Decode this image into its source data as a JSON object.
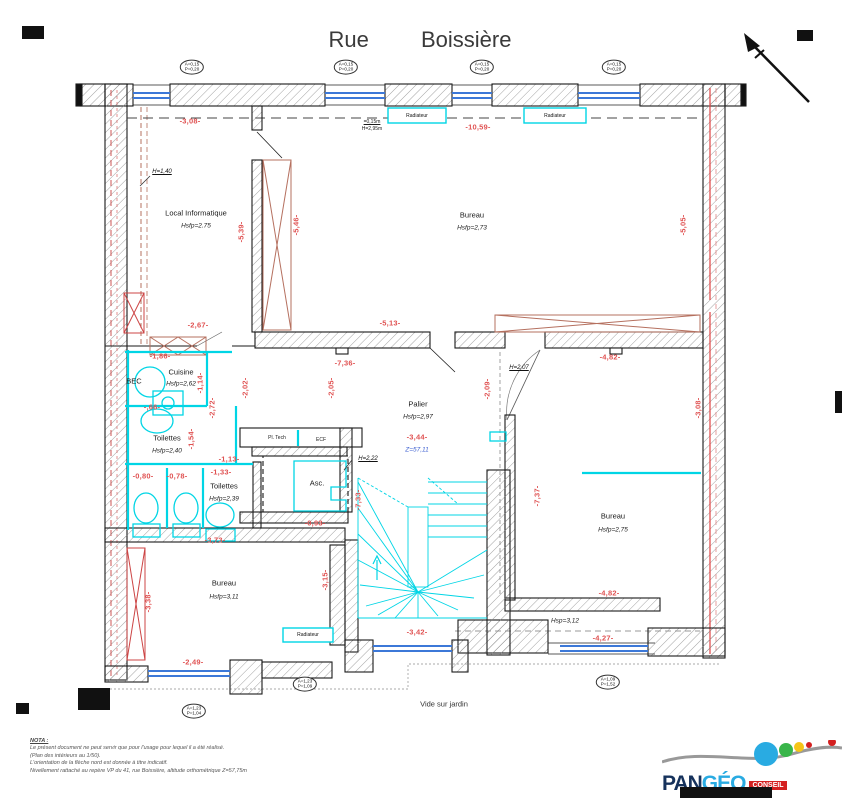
{
  "title": "Rue Boissière",
  "labels": {
    "radiateur": "Radiateur",
    "vide_sur_jardin": "Vide sur jardin",
    "bec": "BEC",
    "pl_tech": "Pl. Tech",
    "ecf": "ECF",
    "asc": "Asc."
  },
  "rooms": {
    "local_informatique": {
      "name": "Local Informatique",
      "height": "Hsfp=2.75"
    },
    "bureau_top": {
      "name": "Bureau",
      "height": "Hsfp=2,73"
    },
    "cuisine": {
      "name": "Cuisine",
      "height": "Hsfp=2,62"
    },
    "toilettes_1": {
      "name": "Toilettes",
      "height": "Hsfp=2,40"
    },
    "toilettes_2": {
      "name": "Toilettes",
      "height": "Hsfp=2,39"
    },
    "palier": {
      "name": "Palier",
      "height": "Hsfp=2,97",
      "level": "-3,44-",
      "z": "Z=57,11"
    },
    "bureau_right": {
      "name": "Bureau",
      "height": "Hsfp=2,75"
    },
    "bureau_bottom": {
      "name": "Bureau",
      "height": "Hsfp=3,11"
    },
    "zone_sud": {
      "height": "Hsp=3,12"
    }
  },
  "dims": {
    "d308_top": "-3,08-",
    "d1059": "-10,59-",
    "d539": "-5,39-",
    "d546": "-5,46-",
    "d505": "-5,05-",
    "d267": "-2,67-",
    "d513": "-5,13-",
    "d482_top": "-4,82-",
    "d736": "-7,36-",
    "d186": "-1,86-",
    "d114": "-1,14-",
    "d202": "-2,02-",
    "d205": "-2,05-",
    "d209": "-2,09-",
    "d272": "-2,72-",
    "d066": "-,66-",
    "d154": "-1,54-",
    "d113": "-1,13-",
    "d308_right": "-3,08-",
    "d080": "-0,80-",
    "d078": "-0,78-",
    "d133": "-1,33-",
    "d733": "-7,33-",
    "d093": "-0,93-",
    "d373": "-3,73-",
    "d737": "-7,37-",
    "d338": "-3,38-",
    "d315": "-3,15-",
    "d249": "-2,49-",
    "d342": "-3,42-",
    "d482_bot": "-4,82-",
    "d427": "-4,27-"
  },
  "annotations": {
    "h140": "H=1,40",
    "allege": "=0,15m",
    "h295": "H=2,95m",
    "h222": "H=2,22",
    "h207": "H=2,07"
  },
  "markers": {
    "top": [
      "A=0,15",
      "P=0,20"
    ],
    "bottom_left": [
      "A=1,23",
      "P=1,04"
    ],
    "bottom_mid": [
      "A=1,23",
      "P=1,09"
    ],
    "bottom_right": [
      "A=1,09",
      "P=1,52"
    ]
  },
  "notes": {
    "title": "NOTA :",
    "lines": [
      "Le présent document ne peut servir que pour l'usage pour lequel il a été réalisé.",
      "(Plan des intérieurs au 1/50).",
      "L'orientation de la flèche nord est donnée à titre indicatif.",
      "Nivellement rattaché au repère VP du 41, rue Boissière, altitude orthométrique Z=57,75m"
    ]
  },
  "logo": {
    "pan": "PAN",
    "geo": "GÉO",
    "conseil": "CONSEIL",
    "tagline_1": "L'énergie de la ",
    "tagline_2": "juste mesure",
    "url": "www.pangeo-conseil.fr"
  },
  "colors": {
    "dim_red": "#e05353",
    "cyan": "#00d5e5",
    "window_blue": "#3c78d8",
    "z_blue": "#3c5fd0",
    "brown": "#b5705f"
  }
}
